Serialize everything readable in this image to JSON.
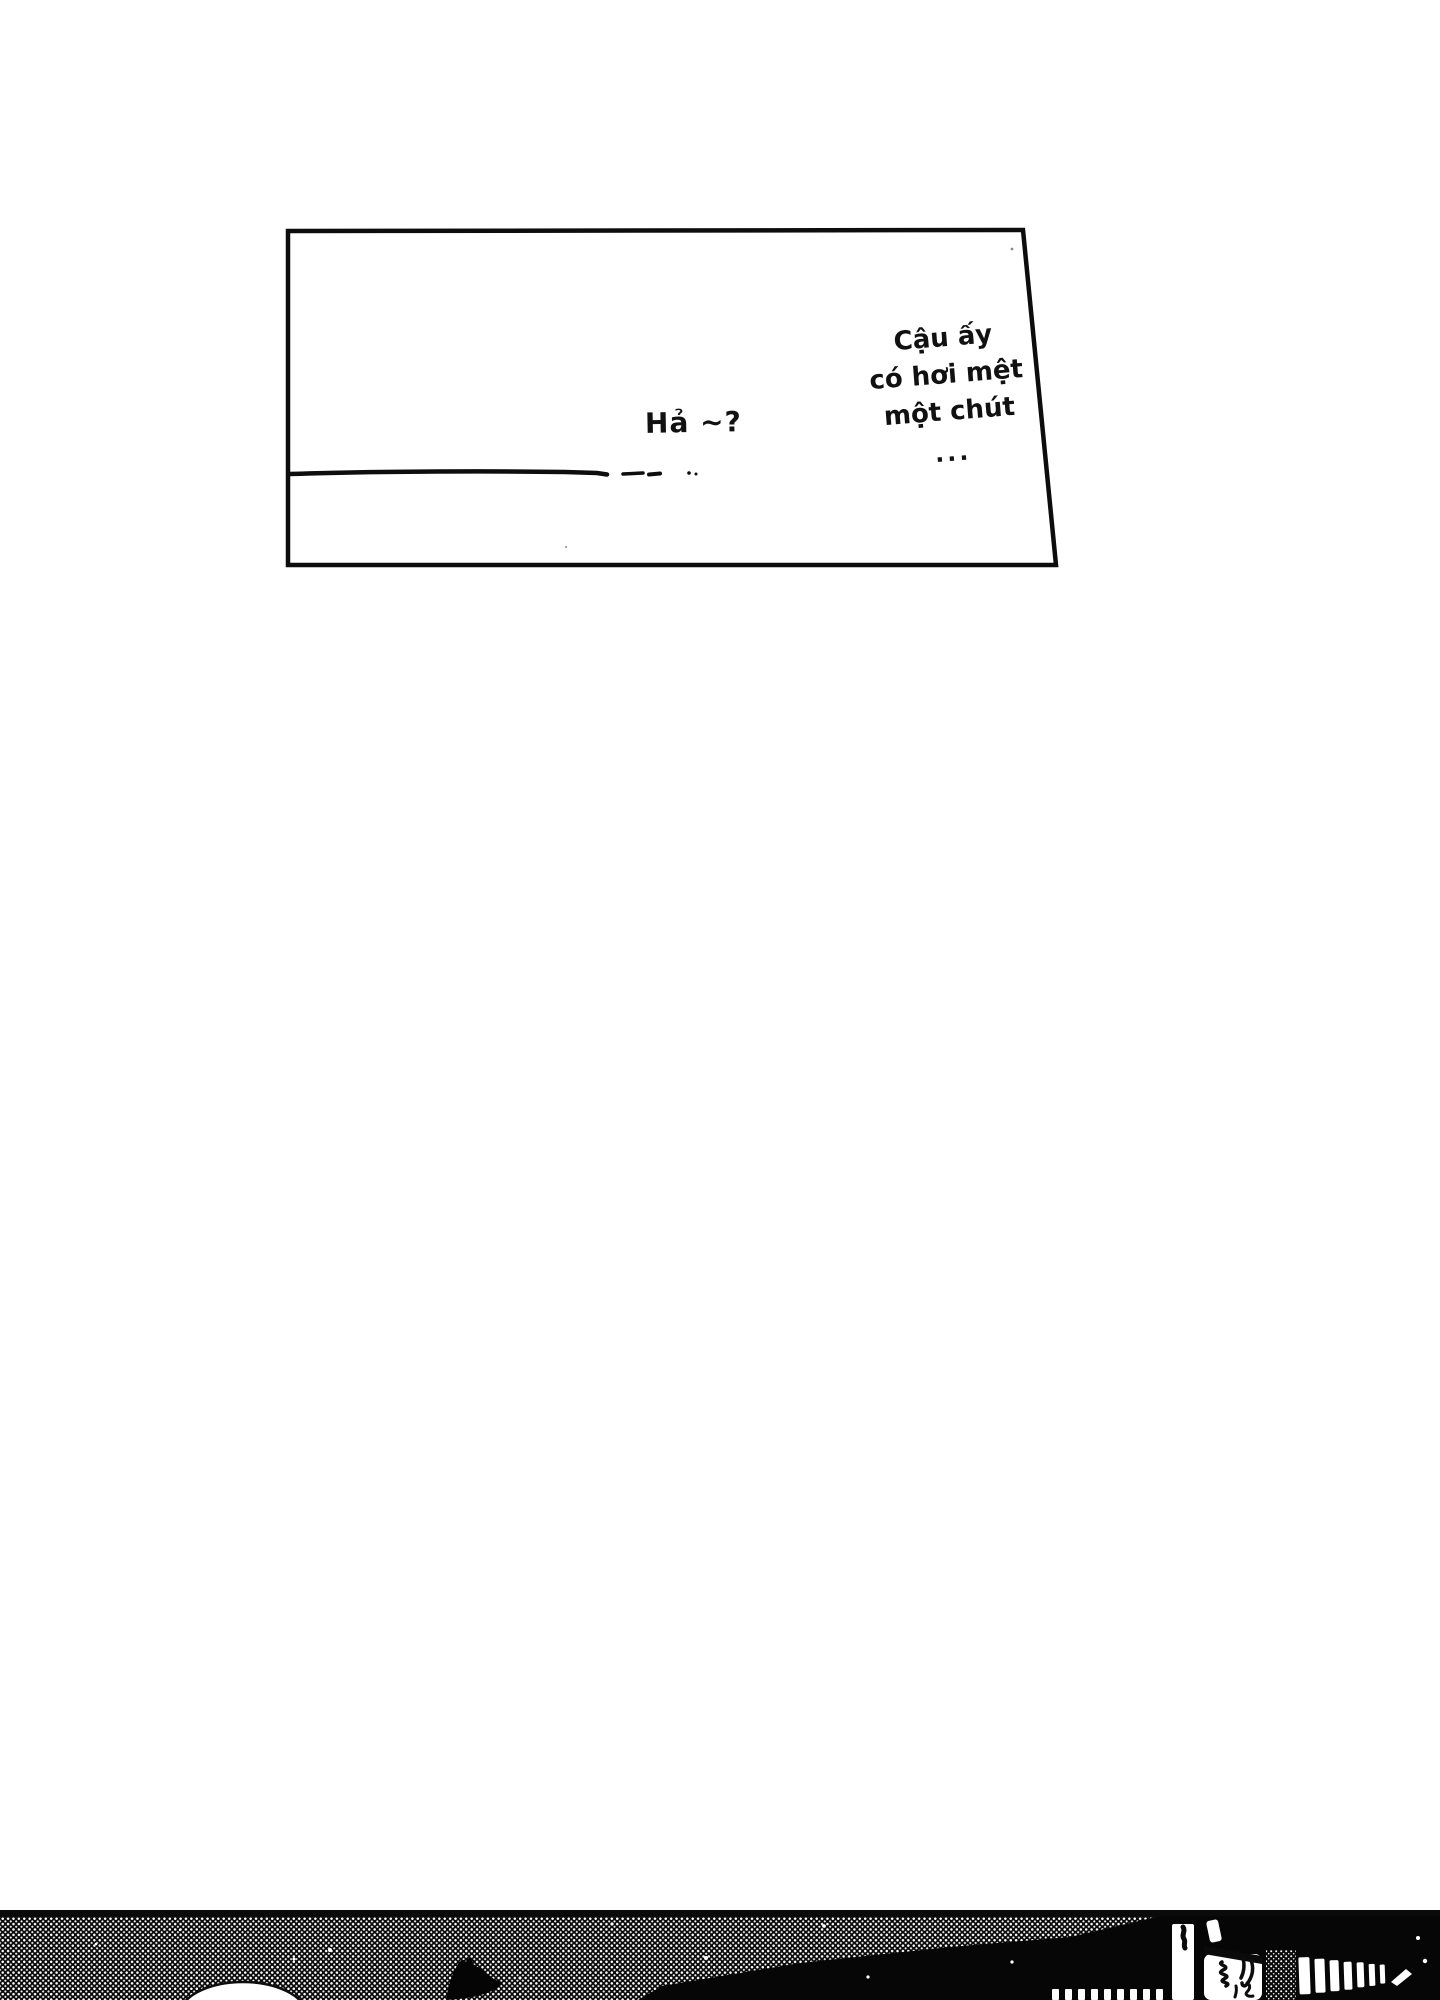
{
  "page": {
    "paper_color": "#ffffff",
    "ink_color": "#0d0d0d"
  },
  "panel": {
    "speech_left": "Hả ~?",
    "speech_right_lines": [
      "Cậu ấy",
      "có hơi mệt",
      "một chút",
      "..."
    ]
  }
}
